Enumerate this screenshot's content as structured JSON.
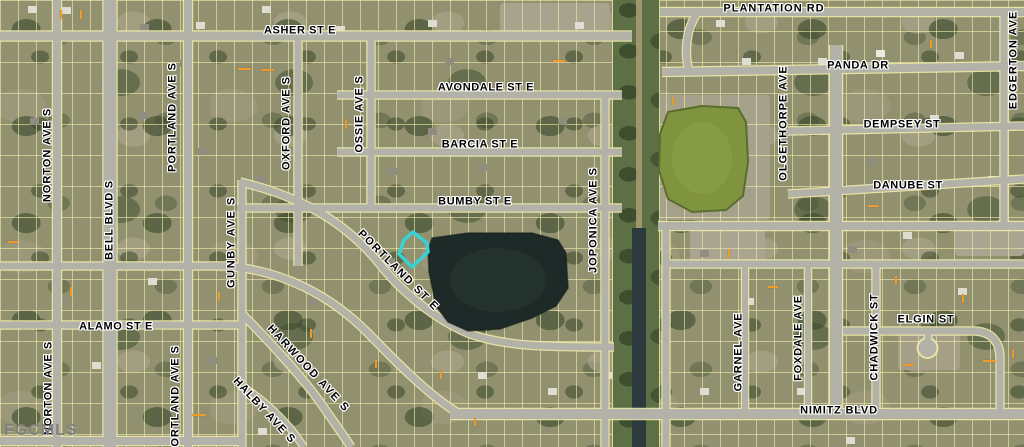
{
  "map": {
    "watermark": "FGCMLS",
    "highlight_color": "#38d2d4",
    "parcel_line_color": "#f2ecaa",
    "road_color": "#b3b2a8",
    "lake_color": "#1e2a27",
    "retention_pond_color": "#80943f",
    "street_labels": [
      {
        "text": "PLANTATION RD",
        "x": 774,
        "y": 9,
        "angle": 0,
        "ls": 1.0
      },
      {
        "text": "ASHER ST E",
        "x": 300,
        "y": 31,
        "angle": 0,
        "ls": 0.6
      },
      {
        "text": "AVONDALE ST E",
        "x": 486,
        "y": 88,
        "angle": 0,
        "ls": 0.6
      },
      {
        "text": "BARCIA ST E",
        "x": 480,
        "y": 145,
        "angle": 0,
        "ls": 0.6
      },
      {
        "text": "BUMBY ST E",
        "x": 475,
        "y": 202,
        "angle": 0,
        "ls": 0.6
      },
      {
        "text": "PANDA DR",
        "x": 858,
        "y": 66,
        "angle": 0,
        "ls": 0.6
      },
      {
        "text": "DEMPSEY ST",
        "x": 902,
        "y": 125,
        "angle": 0,
        "ls": 0.6
      },
      {
        "text": "DANUBE ST",
        "x": 908,
        "y": 186,
        "angle": 0,
        "ls": 0.6
      },
      {
        "text": "ALAMO ST E",
        "x": 116,
        "y": 327,
        "angle": 0,
        "ls": 0.6
      },
      {
        "text": "ELGIN ST",
        "x": 926,
        "y": 320,
        "angle": 0,
        "ls": 0.8
      },
      {
        "text": "NIMITZ BLVD",
        "x": 839,
        "y": 411,
        "angle": 0,
        "ls": 0.8
      },
      {
        "text": "NORTON AVE S",
        "x": 48,
        "y": 155,
        "angle": -90,
        "ls": 1.0
      },
      {
        "text": "NORTON AVE S",
        "x": 49,
        "y": 388,
        "angle": -90,
        "ls": 1.0
      },
      {
        "text": "BELL BLVD S",
        "x": 110,
        "y": 220,
        "angle": -90,
        "ls": 0.8
      },
      {
        "text": "PORTLAND AVE S",
        "x": 173,
        "y": 117,
        "angle": -90,
        "ls": 1.0
      },
      {
        "text": "PORTLAND AVE S",
        "x": 176,
        "y": 400,
        "angle": -90,
        "ls": 1.0
      },
      {
        "text": "OXFORD AVE S",
        "x": 287,
        "y": 123,
        "angle": -90,
        "ls": 1.0
      },
      {
        "text": "GUNBY AVE S",
        "x": 232,
        "y": 242,
        "angle": -90,
        "ls": 1.6
      },
      {
        "text": "OSSIE AVE S",
        "x": 360,
        "y": 114,
        "angle": -90,
        "ls": 0.8
      },
      {
        "text": "JOPONICA AVE S",
        "x": 594,
        "y": 220,
        "angle": -90,
        "ls": 1.0
      },
      {
        "text": "OLGETHORPE AVE",
        "x": 784,
        "y": 123,
        "angle": -90,
        "ls": 1.0
      },
      {
        "text": "EDGERTON AVE",
        "x": 1014,
        "y": 60,
        "angle": -90,
        "ls": 1.0
      },
      {
        "text": "GARNEL AVE",
        "x": 739,
        "y": 352,
        "angle": -90,
        "ls": 0.8
      },
      {
        "text": "FOXDALE AVE",
        "x": 799,
        "y": 338,
        "angle": -90,
        "ls": 0.8
      },
      {
        "text": "CHADWICK ST",
        "x": 875,
        "y": 337,
        "angle": -90,
        "ls": 0.8
      },
      {
        "text": "PORTLAND ST E",
        "x": 398,
        "y": 271,
        "angle": 45,
        "ls": 1.6
      },
      {
        "text": "HARWOOD AVE S",
        "x": 308,
        "y": 369,
        "angle": 47,
        "ls": 1.6
      },
      {
        "text": "HALBY AVE S",
        "x": 264,
        "y": 411,
        "angle": 47,
        "ls": 1.2
      }
    ]
  }
}
